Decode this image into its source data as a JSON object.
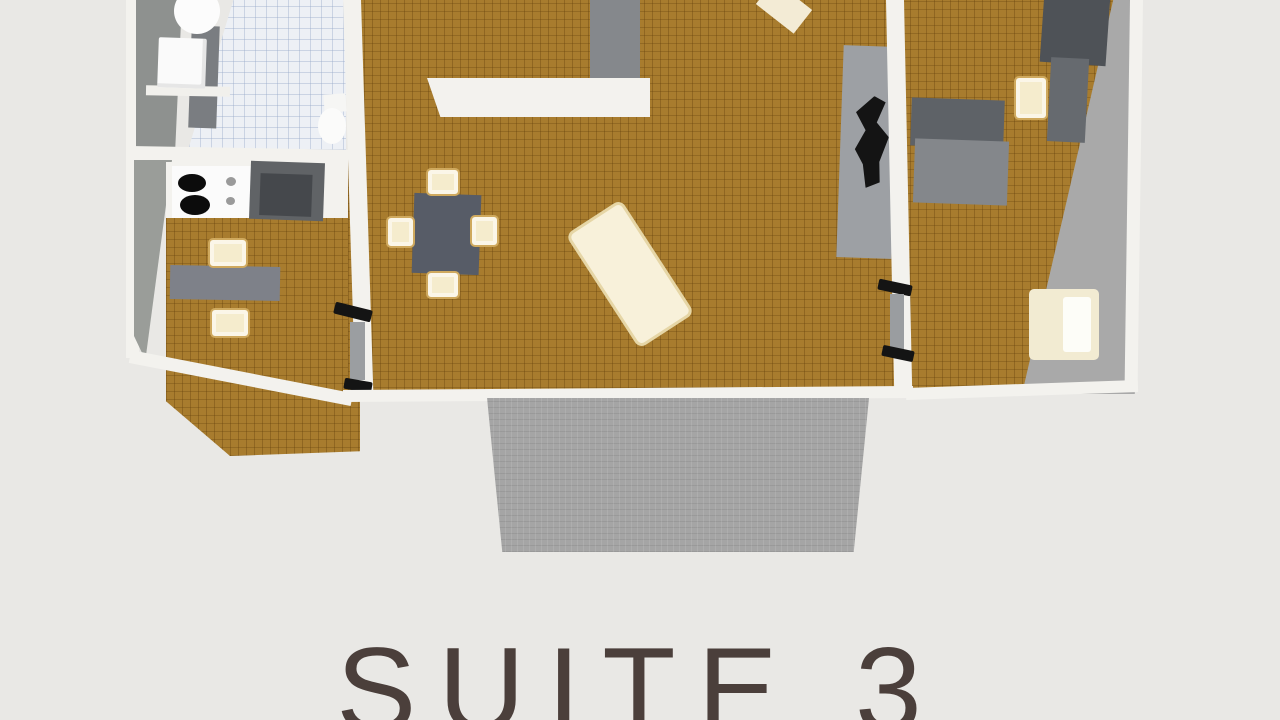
{
  "title": "SUITE 3",
  "colors": {
    "bg": "#e9e8e5",
    "wall_white": "#f3f2ee",
    "wall_gray": "#96999a",
    "wood": "#a87c2e",
    "wood_line": "#8a651f",
    "tile": "#edf0f5",
    "tile_line": "#ccd4e2",
    "balcony": "#a5a5a5",
    "furn_gray_dark": "#54585d",
    "furn_gray": "#83868b",
    "table_gray": "#575c67",
    "cream": "#f5eccd",
    "cream_border": "#cfa95e",
    "tv_black": "#141414",
    "title_color": "#4b3f3b"
  },
  "objects": [
    "bathroom-sink",
    "washing-machine",
    "toilet",
    "bathroom-tile-floor",
    "stove",
    "refrigerator",
    "desk",
    "desk-chairs",
    "dining-table",
    "dining-chairs",
    "mattress",
    "tv-stand",
    "tv",
    "bed",
    "wardrobe",
    "bedroom-chair",
    "armchair",
    "balcony"
  ]
}
